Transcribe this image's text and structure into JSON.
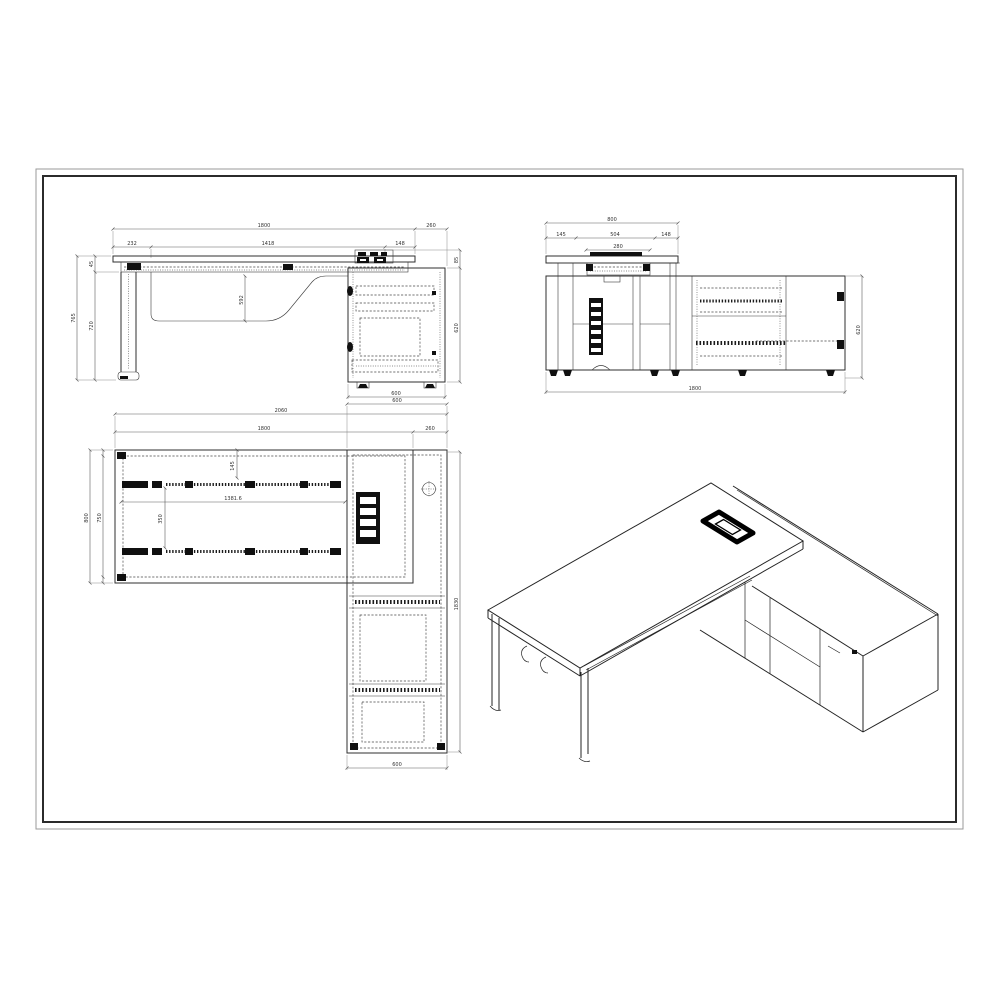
{
  "sheet": {
    "background": "#ffffff",
    "border_outer_color": "#9a9a9a",
    "border_inner_color": "#2b2b2b",
    "line_color": "#2f2f2f"
  },
  "dims": {
    "fe_total": "1800",
    "fe_ext": "260",
    "fe_a": "232",
    "fe_b": "1418",
    "fe_c": "148",
    "fe_h": "765",
    "fe_h1": "45",
    "fe_h2": "720",
    "fe_mid": "592",
    "fe_gap": "85",
    "fe_cab_h": "620",
    "fe_cab_w": "600",
    "se_depth": "800",
    "se_a": "145",
    "se_b": "504",
    "se_c": "148",
    "se_d": "280",
    "se_h": "620",
    "se_len": "1800",
    "pl_cab_w_top": "600",
    "pl_total": "2060",
    "pl_desk_w": "1800",
    "pl_ext": "260",
    "pl_depth": "800",
    "pl_depth_in": "750",
    "pl_inset": "145",
    "pl_beam": "1381.6",
    "pl_beam_gap": "350",
    "pl_len": "1830",
    "pl_cab_w_bot": "600"
  }
}
